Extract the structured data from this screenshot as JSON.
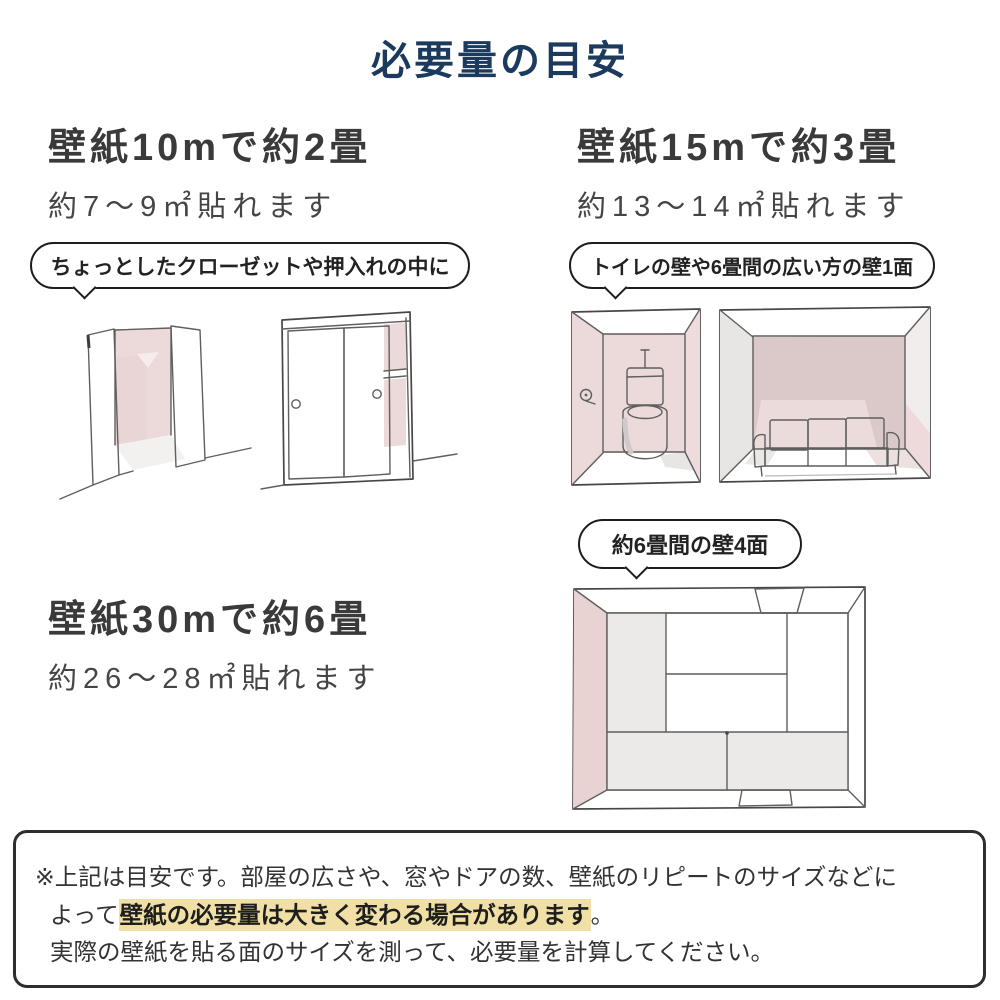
{
  "title": "必要量の目安",
  "colors": {
    "title_navy": "#1b3a5e",
    "heading_gray": "#3a3a3a",
    "wall_pink": "#ecd9d9",
    "wall_pink_dark": "#dbc8c8",
    "wall_gray": "#e8e5e5",
    "highlight_yellow": "#f1e0a6"
  },
  "sections": {
    "s10m": {
      "heading": "壁紙10mで約2畳",
      "subtitle": "約7〜9㎡貼れます",
      "bubble": "ちょっとしたクローゼットや押入れの中に",
      "illustrations": [
        "open-closet",
        "sliding-door-closet"
      ]
    },
    "s15m": {
      "heading": "壁紙15mで約3畳",
      "subtitle": "約13〜14㎡貼れます",
      "bubble": "トイレの壁や6畳間の広い方の壁1面",
      "illustrations": [
        "toilet-room",
        "sofa-room"
      ]
    },
    "s30m": {
      "heading": "壁紙30mで約6畳",
      "subtitle": "約26〜28㎡貼れます",
      "bubble": "約6畳間の壁4面",
      "illustrations": [
        "tatami-room-topdown"
      ]
    }
  },
  "note": {
    "line1": "※上記は目安です。部屋の広さや、窓やドアの数、壁紙のリピートのサイズなどに",
    "line2_prefix": "よって",
    "line2_highlight": "壁紙の必要量は大きく変わる場合があります",
    "line2_suffix": "。",
    "line3": "実際の壁紙を貼る面のサイズを測って、必要量を計算してください。"
  }
}
